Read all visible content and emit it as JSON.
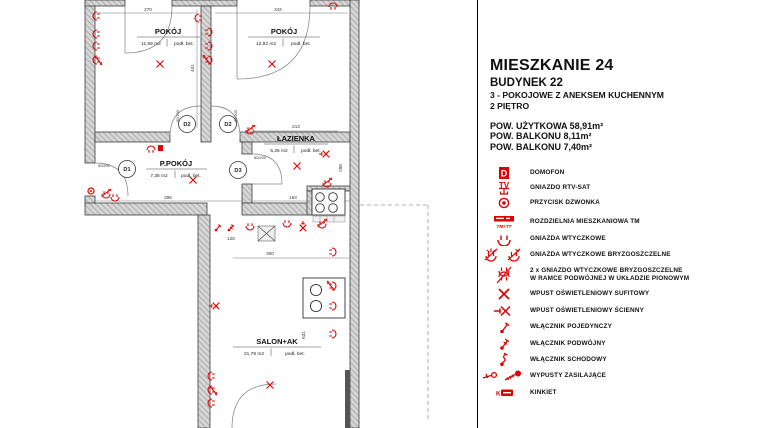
{
  "accent_red": "#e00000",
  "compass": {
    "north_label": "N"
  },
  "header": {
    "title": "MIESZKANIE 24",
    "building": "BUDYNEK 22",
    "type_line": "3 - POKOJOWE Z ANEKSEM KUCHENNYM",
    "floor_line": "2 PIĘTRO",
    "area_usable": "POW. UŻYTKOWA 58,91m²",
    "area_balcony1": "POW. BALKONU 8,11m²",
    "area_balcony2": "POW. BALKONU 7,40m²"
  },
  "legend": {
    "domofon_letter": "D",
    "rtv_letters": "TV",
    "kinkiet_letter": "K",
    "items": [
      {
        "label": "DOMOFON"
      },
      {
        "label": "GNIAZDO RTV-SAT"
      },
      {
        "label": "PRZYCISK DZWONKA"
      },
      {
        "label": "ROZDZIELNIA MIESZKANIOWA TM",
        "sublabel": "TM+TT"
      },
      {
        "label": "GNIAZDA WTYCZKOWE"
      },
      {
        "label": "GNIAZDA WTYCZKOWE BRYZGOSZCZELNE"
      },
      {
        "label": "2 x GNIAZDO WTYCZKOWE BRYZGOSZCZELNE",
        "label2": "W RAMCE PODWÓJNEJ W UKŁADZIE PIONOWYM"
      },
      {
        "label": "WPUST OŚWIETLENIOWY SUFITOWY"
      },
      {
        "label": "WPUST OŚWIETLENIOWY ŚCIENNY"
      },
      {
        "label": "WŁĄCZNIK POJEDYNCZY"
      },
      {
        "label": "WŁĄCZNIK PODWÓJNY"
      },
      {
        "label": "WŁĄCZNIK SCHODOWY"
      },
      {
        "label": "WYPUSTY ZASILAJĄCE"
      },
      {
        "label": "KINKIET"
      }
    ]
  },
  "plan": {
    "rooms": [
      {
        "name": "POKÓJ",
        "area": "11,59 m2",
        "floor": "podł. bet."
      },
      {
        "name": "POKÓJ",
        "area": "12,92 m2",
        "floor": "podł. bet."
      },
      {
        "name": "ŁAZIENKA",
        "area": "5,25 m2",
        "floor": "podł. bet."
      },
      {
        "name": "P.POKÓJ",
        "area": "7,36 m2",
        "floor": "podł. bet."
      },
      {
        "name": "SALON+AK",
        "area": "21,79 m2",
        "floor": "podł. bet."
      }
    ],
    "doors": [
      "D1",
      "D2",
      "D2",
      "D3"
    ],
    "door_sizes": [
      "90/200",
      "80/200",
      "80/200",
      "80/200"
    ],
    "dims": {
      "w1": "270",
      "w2": "342",
      "h1": "441",
      "hall": "395",
      "kitchen": "153",
      "bath_w": "213",
      "bath_h": "288",
      "sw": "125",
      "open": "300",
      "salon_h": "631"
    }
  }
}
